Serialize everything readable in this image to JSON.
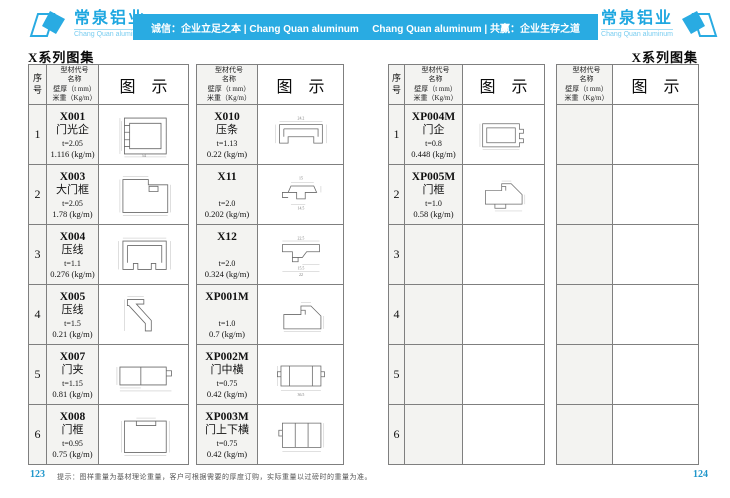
{
  "colors": {
    "brand_blue": "#29abe2",
    "page_number_blue": "#2197cb"
  },
  "header": {
    "logo_left": {
      "name": "常泉铝业",
      "subtitle": "Chang Quan aluminum"
    },
    "logo_right": {
      "name": "常泉铝业",
      "subtitle": "Chang Quan aluminum"
    },
    "banner": {
      "left_slogan": "诚信：企业立足之本 | Chang Quan aluminum",
      "right_slogan": "Chang Quan aluminum | 共赢：企业生存之道"
    }
  },
  "titles": {
    "left": "X系列图集",
    "right": "X系列图集"
  },
  "table_header": {
    "col_index": "序号",
    "col_info_lines": [
      "型材代号",
      "名称",
      "壁厚（t mm）",
      "米重（Kg/m）"
    ],
    "col_diagram": "图 示"
  },
  "tables": [
    {
      "id": "left-page-table-1",
      "has_index": true,
      "rows": [
        {
          "index": "1",
          "code": "X001",
          "name": "门光企",
          "thickness": "t=2.05",
          "weight": "1.116 (kg/m)",
          "diagram": {
            "shape": "channel",
            "dims": [
              {
                "text": "54",
                "pos": "bottom"
              }
            ]
          }
        },
        {
          "index": "2",
          "code": "X003",
          "name": "大门框",
          "thickness": "t=2.05",
          "weight": "1.78 (kg/m)",
          "diagram": {
            "shape": "step",
            "dims": []
          }
        },
        {
          "index": "3",
          "code": "X004",
          "name": "压线",
          "thickness": "t=1.1",
          "weight": "0.276 (kg/m)",
          "diagram": {
            "shape": "hat",
            "dims": []
          }
        },
        {
          "index": "4",
          "code": "X005",
          "name": "压线",
          "thickness": "t=1.5",
          "weight": "0.21 (kg/m)",
          "diagram": {
            "shape": "zprof",
            "dims": []
          }
        },
        {
          "index": "5",
          "code": "X007",
          "name": "门夹",
          "thickness": "t=1.15",
          "weight": "0.81 (kg/m)",
          "diagram": {
            "shape": "drect",
            "dims": []
          }
        },
        {
          "index": "6",
          "code": "X008",
          "name": "门框",
          "thickness": "t=0.95",
          "weight": "0.75 (kg/m)",
          "diagram": {
            "shape": "recttab",
            "dims": []
          }
        }
      ]
    },
    {
      "id": "left-page-table-2",
      "has_index": false,
      "rows": [
        {
          "code": "X010",
          "name": "压条",
          "thickness": "t=1.13",
          "weight": "0.22 (kg/m)",
          "diagram": {
            "shape": "shallow",
            "dims": [
              {
                "text": "24.2",
                "pos": "top"
              }
            ]
          }
        },
        {
          "code": "X11",
          "name": "",
          "thickness": "t=2.0",
          "weight": "0.202 (kg/m)",
          "diagram": {
            "shape": "zig",
            "dims": [
              {
                "text": "15",
                "pos": "top"
              },
              {
                "text": "14.5",
                "pos": "mid"
              }
            ]
          }
        },
        {
          "code": "X12",
          "name": "",
          "thickness": "t=2.0",
          "weight": "0.324 (kg/m)",
          "diagram": {
            "shape": "aflange",
            "dims": [
              {
                "text": "22.5",
                "pos": "top"
              },
              {
                "text": "15.5",
                "pos": "mid"
              },
              {
                "text": "22",
                "pos": "bottom"
              }
            ]
          }
        },
        {
          "code": "XP001M",
          "name": "",
          "thickness": "t=1.0",
          "weight": "0.7 (kg/m)",
          "diagram": {
            "shape": "chamf",
            "dims": []
          }
        },
        {
          "code": "XP002M",
          "name": "门中横",
          "thickness": "t=0.75",
          "weight": "0.42 (kg/m)",
          "diagram": {
            "shape": "hprof",
            "dims": [
              {
                "text": "36.5",
                "pos": "bottom"
              }
            ]
          }
        },
        {
          "code": "XP003M",
          "name": "门上下横",
          "thickness": "t=0.75",
          "weight": "0.42 (kg/m)",
          "diagram": {
            "shape": "tridiv",
            "dims": []
          }
        }
      ]
    },
    {
      "id": "right-page-table-1",
      "has_index": true,
      "rows": [
        {
          "index": "1",
          "code": "XP004M",
          "name": "门企",
          "thickness": "t=0.8",
          "weight": "0.448 (kg/m)",
          "diagram": {
            "shape": "rnotch",
            "dims": []
          }
        },
        {
          "index": "2",
          "code": "XP005M",
          "name": "门框",
          "thickness": "t=1.0",
          "weight": "0.58 (kg/m)",
          "diagram": {
            "shape": "chamf2",
            "dims": []
          }
        },
        {
          "index": "3"
        },
        {
          "index": "4"
        },
        {
          "index": "5"
        },
        {
          "index": "6"
        }
      ]
    },
    {
      "id": "right-page-table-2",
      "has_index": false,
      "rows": [
        {},
        {},
        {},
        {},
        {},
        {}
      ]
    }
  ],
  "footer": {
    "page_left": "123",
    "note": "提示：图样重量为基材理论重量，客户可根据需要的厚度订购，实际重量以过磅时的重量为准。",
    "page_right": "124"
  }
}
